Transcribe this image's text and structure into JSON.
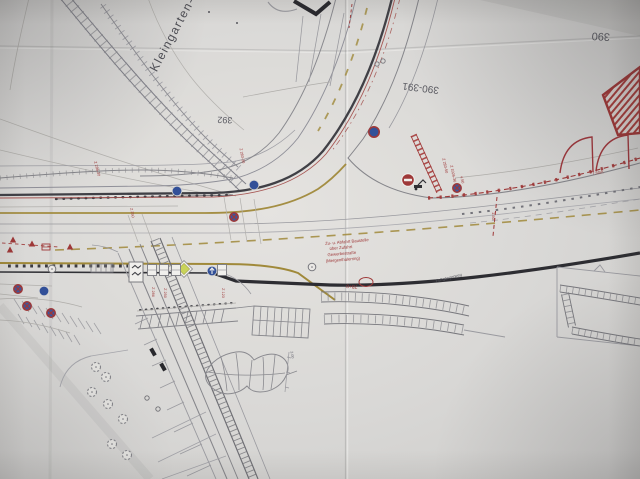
{
  "colors": {
    "paper": "#dcdad7",
    "ink_dark": "#3f3f45",
    "ink_mid": "#80808a",
    "ink_light": "#a6a6ac",
    "red": "#a83434",
    "olive": "#a3892f",
    "blue": "#2d4fa1",
    "green": "#cbd64d"
  },
  "plan": {
    "labels": [
      {
        "n": "kleingarten-label",
        "t": "Kleingarten-",
        "x": 176,
        "y": 36,
        "r": -62,
        "s": 12,
        "c": "#4e4e56",
        "ls": 1.5
      },
      {
        "n": "grid-392",
        "t": "392",
        "x": 225,
        "y": 117,
        "r": 182,
        "s": 9,
        "c": "#5a5a62"
      },
      {
        "n": "grid-390-391",
        "t": "390-391",
        "x": 421,
        "y": 85,
        "r": 187,
        "s": 10,
        "c": "#5a5a62"
      },
      {
        "n": "grid-390",
        "t": "390",
        "x": 601,
        "y": 33,
        "r": 183,
        "s": 11,
        "c": "#5a5a62"
      },
      {
        "n": "note-line-1",
        "t": "Zu- u. Abfahrt Baustelle",
        "x": 347,
        "y": 243,
        "r": -5,
        "s": 4.2
      },
      {
        "n": "note-line-2",
        "t": "über Zufahrt",
        "x": 341,
        "y": 249,
        "r": -5,
        "s": 4.2
      },
      {
        "n": "note-line-3",
        "t": "Gewerbestraße",
        "x": 342,
        "y": 255,
        "r": -5,
        "s": 4.2
      },
      {
        "n": "note-line-4",
        "t": "(Mergenthalerring)",
        "x": 343,
        "y": 261,
        "r": -5,
        "s": 4.2
      },
      {
        "n": "dim-750",
        "t": "7.50m",
        "x": 598,
        "y": 174,
        "r": -8,
        "s": 4
      },
      {
        "n": "dim-150",
        "t": "1.50",
        "x": 492,
        "y": 216,
        "r": 90,
        "s": 4
      },
      {
        "n": "sign-code-1",
        "t": "Z 283-50",
        "x": 444,
        "y": 166,
        "r": 78,
        "s": 3.8
      },
      {
        "n": "sign-code-2",
        "t": "Z 1026-36",
        "x": 452,
        "y": 174,
        "r": 78,
        "s": 3.8
      },
      {
        "n": "dim-450",
        "t": "4.50",
        "x": 461,
        "y": 180,
        "r": 78,
        "s": 3.8
      },
      {
        "n": "sign-code-3",
        "t": "Z 286",
        "x": 152,
        "y": 292,
        "r": 90,
        "s": 3.8
      },
      {
        "n": "sign-code-4",
        "t": "Z 250",
        "x": 164,
        "y": 293,
        "r": 90,
        "s": 3.8
      },
      {
        "n": "sign-code-5",
        "t": "Z 123",
        "x": 222,
        "y": 293,
        "r": 90,
        "s": 3.8
      },
      {
        "n": "sign-code-6",
        "t": "Z 283-30",
        "x": 241,
        "y": 156,
        "r": 80,
        "s": 3.8
      },
      {
        "n": "sign-code-7",
        "t": "Z 286-30",
        "x": 96,
        "y": 169,
        "r": 76,
        "s": 3.8
      },
      {
        "n": "sign-code-8",
        "t": "Z 250",
        "x": 131,
        "y": 213,
        "r": 80,
        "s": 3.8
      },
      {
        "n": "station-label",
        "t": "78+0",
        "x": 352,
        "y": 285,
        "r": 184,
        "s": 5
      },
      {
        "n": "path-label",
        "t": "Fußgängerweg",
        "x": 449,
        "y": 279,
        "r": -14,
        "s": 4,
        "c": "#5a5a62"
      },
      {
        "n": "dim-300",
        "t": "3.00",
        "x": 291,
        "y": 355,
        "r": 80,
        "s": 3.8,
        "c": "#70707a"
      }
    ],
    "signs": [
      {
        "type": "stop",
        "x": 408,
        "y": 180
      },
      {
        "type": "blue",
        "x": 177,
        "y": 191
      },
      {
        "type": "blue",
        "x": 254,
        "y": 185
      },
      {
        "type": "blue",
        "x": 44,
        "y": 291
      },
      {
        "type": "blue_red",
        "x": 374,
        "y": 132
      },
      {
        "type": "blue_arrow",
        "x": 212,
        "y": 271
      },
      {
        "type": "no_stopping",
        "x": 234,
        "y": 217
      },
      {
        "type": "no_stopping",
        "x": 18,
        "y": 289
      },
      {
        "type": "no_stopping",
        "x": 27,
        "y": 306
      },
      {
        "type": "no_stopping",
        "x": 51,
        "y": 313
      },
      {
        "type": "no_stopping",
        "x": 457,
        "y": 188
      },
      {
        "type": "gray_ring",
        "x": 312,
        "y": 267
      },
      {
        "type": "gray_ring",
        "x": 52,
        "y": 269
      },
      {
        "type": "small_circle",
        "x": 147,
        "y": 398
      },
      {
        "type": "small_circle",
        "x": 158,
        "y": 409
      },
      {
        "type": "diamond",
        "x": 184,
        "y": 269
      },
      {
        "type": "chevron_box",
        "x": 136,
        "y": 272
      },
      {
        "type": "excavator",
        "x": 418,
        "y": 186
      },
      {
        "type": "box",
        "x": 152,
        "y": 270
      },
      {
        "type": "box",
        "x": 164,
        "y": 270
      },
      {
        "type": "box",
        "x": 176,
        "y": 270
      },
      {
        "type": "box",
        "x": 222,
        "y": 270
      },
      {
        "type": "comb",
        "x": 102,
        "y": 268
      },
      {
        "type": "red_triangle",
        "x": 13,
        "y": 240
      },
      {
        "type": "red_triangle",
        "x": 32,
        "y": 244
      },
      {
        "type": "red_triangle",
        "x": 10,
        "y": 250
      },
      {
        "type": "red_triangle",
        "x": 70,
        "y": 247
      },
      {
        "type": "red_box",
        "x": 46,
        "y": 247
      },
      {
        "type": "car",
        "x": 153,
        "y": 352
      },
      {
        "type": "car",
        "x": 163,
        "y": 367
      },
      {
        "type": "red_ellipse",
        "x": 366,
        "y": 282
      }
    ],
    "trees": [
      [
        96,
        367
      ],
      [
        106,
        377
      ],
      [
        92,
        392
      ],
      [
        108,
        404
      ],
      [
        123,
        419
      ],
      [
        112,
        444
      ],
      [
        127,
        455
      ]
    ]
  }
}
